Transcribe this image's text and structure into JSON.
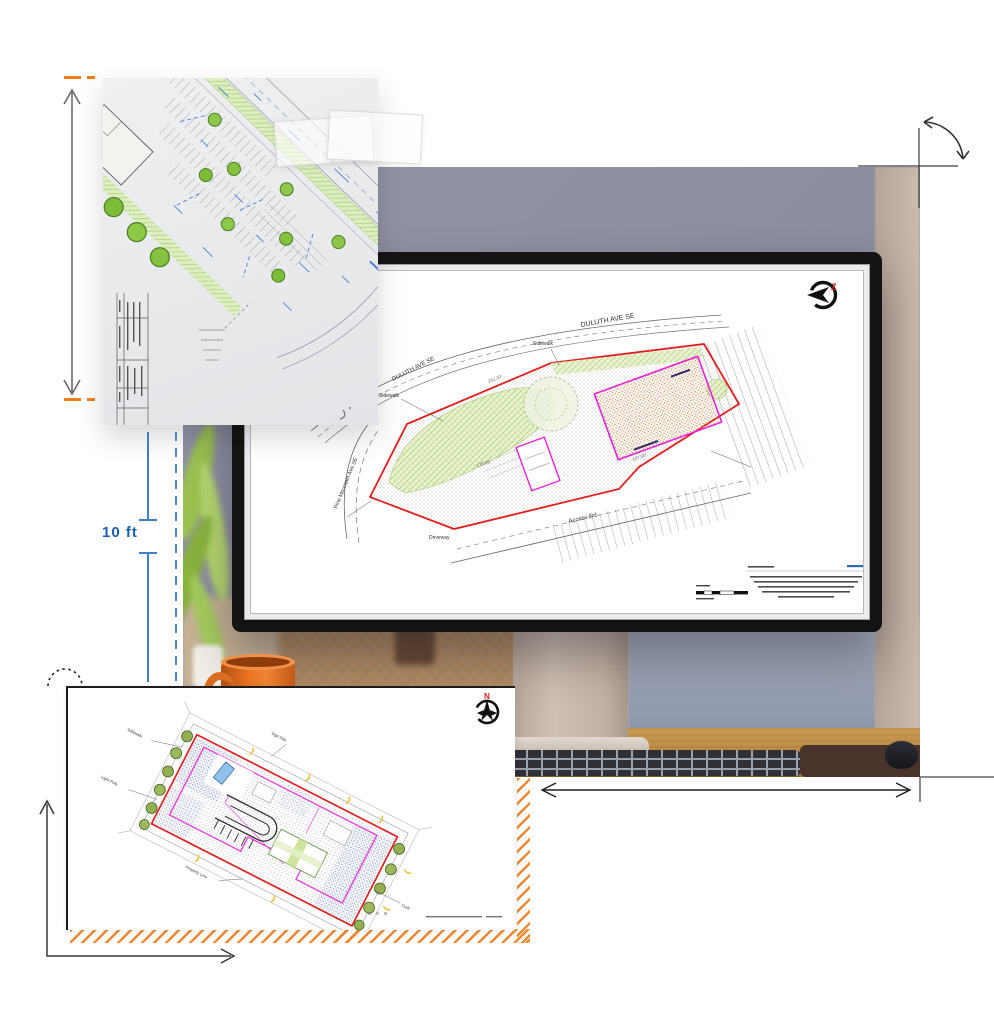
{
  "annotations": {
    "distance_label": "10 ft",
    "colors": {
      "blue": "#3f7ec2",
      "orange": "#f07d1a",
      "arrow_gray": "#5f5f5f",
      "guide_black": "#2e2e2e"
    }
  },
  "photo": {
    "wall_color": "#8d8fa1",
    "accent_wall_color": "#cbbcae",
    "desk_color": "#b9873f",
    "mug_color": "#e8711f"
  },
  "monitor_plan": {
    "compass_letter": "Z",
    "streets": {
      "top": "DULUTH AVE SE",
      "upper_left": "DULUTH AVE SE",
      "left": "Pine Mountain Ave SE",
      "bottom": "Access Rd"
    },
    "labels": {
      "sidewalk_a": "Sidewalk",
      "sidewalk_b": "Sidewalk",
      "driveway": "Driveway"
    },
    "dims": {
      "d1": "201.32'",
      "d2": "178.95'",
      "d3": "107.00'"
    },
    "colors": {
      "boundary": "#e02020",
      "building_outline": "#e823d6",
      "landscape": "#cfe3a4",
      "building_fill": "#d07828"
    }
  },
  "bottom_sheet": {
    "compass_letter": "N",
    "labels": {
      "l1": "Sidewalk",
      "l2": "Light Pole",
      "l3": "Property Line",
      "l4": "Sign Dist",
      "l5": "Curb"
    },
    "colors": {
      "boundary": "#e02020",
      "building_outline": "#ee3ad6",
      "hatch": "#f28a33"
    }
  }
}
